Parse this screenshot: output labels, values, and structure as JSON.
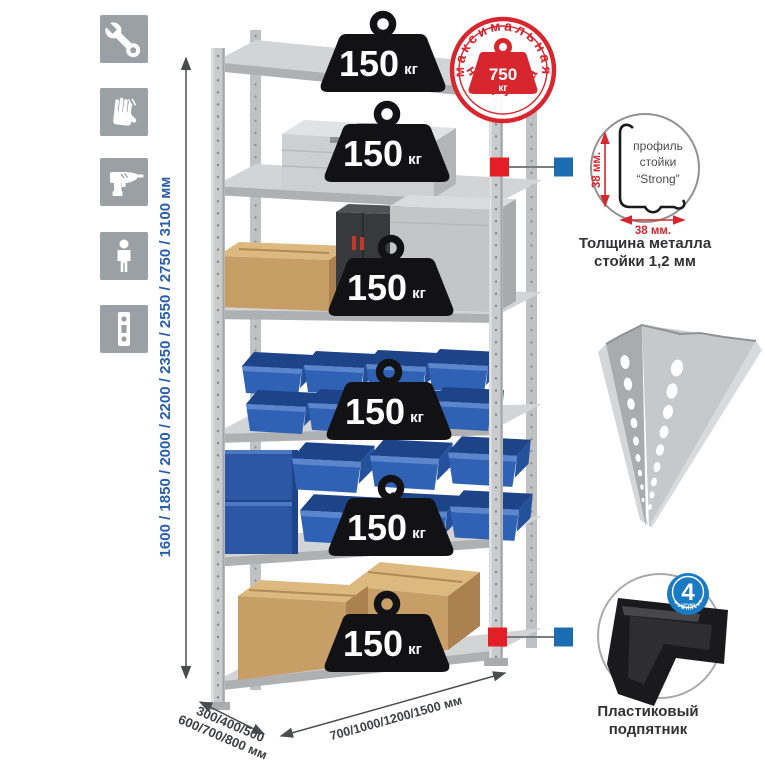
{
  "sidebar": {
    "icons": [
      "wrench-icon",
      "gloves-icon",
      "drill-icon",
      "person-icon",
      "perforated-strip-icon"
    ]
  },
  "height_dimension": {
    "label": "1600 / 1850 / 2000 / 2200 / 2350 / 2550 / 2750 / 3100 мм"
  },
  "depth_dimension": {
    "line1": "300/400/500",
    "line2": "600/700/800 мм"
  },
  "width_dimension": {
    "label": "700/1000/1200/1500 мм"
  },
  "shelves": {
    "count": 6,
    "per_shelf_load": {
      "value": "150",
      "unit": "кг"
    }
  },
  "stamp": {
    "arc_top": "максимальная",
    "arc_bottom": "нагрузка",
    "value": "750",
    "unit": "кг"
  },
  "profile": {
    "vertical_dim": "38 мм.",
    "horizontal_dim": "38 мм.",
    "line1": "профиль",
    "line2": "стойки",
    "line3": "“Strong”",
    "caption1": "Толщина металла",
    "caption2": "стойки 1,2 мм"
  },
  "foot": {
    "badge_value": "4",
    "badge_sub": "штуки",
    "badge_arc": "в комплекте",
    "caption1": "Пластиковый",
    "caption2": "подпятник"
  },
  "colors": {
    "accent_blue": "#2a5ea9",
    "stamp_red": "#d8262e",
    "marker_red": "#e21f26",
    "marker_blue": "#1d6bb0",
    "badge_blue": "#1a7ac2",
    "icon_gray": "#9aa0a3"
  }
}
